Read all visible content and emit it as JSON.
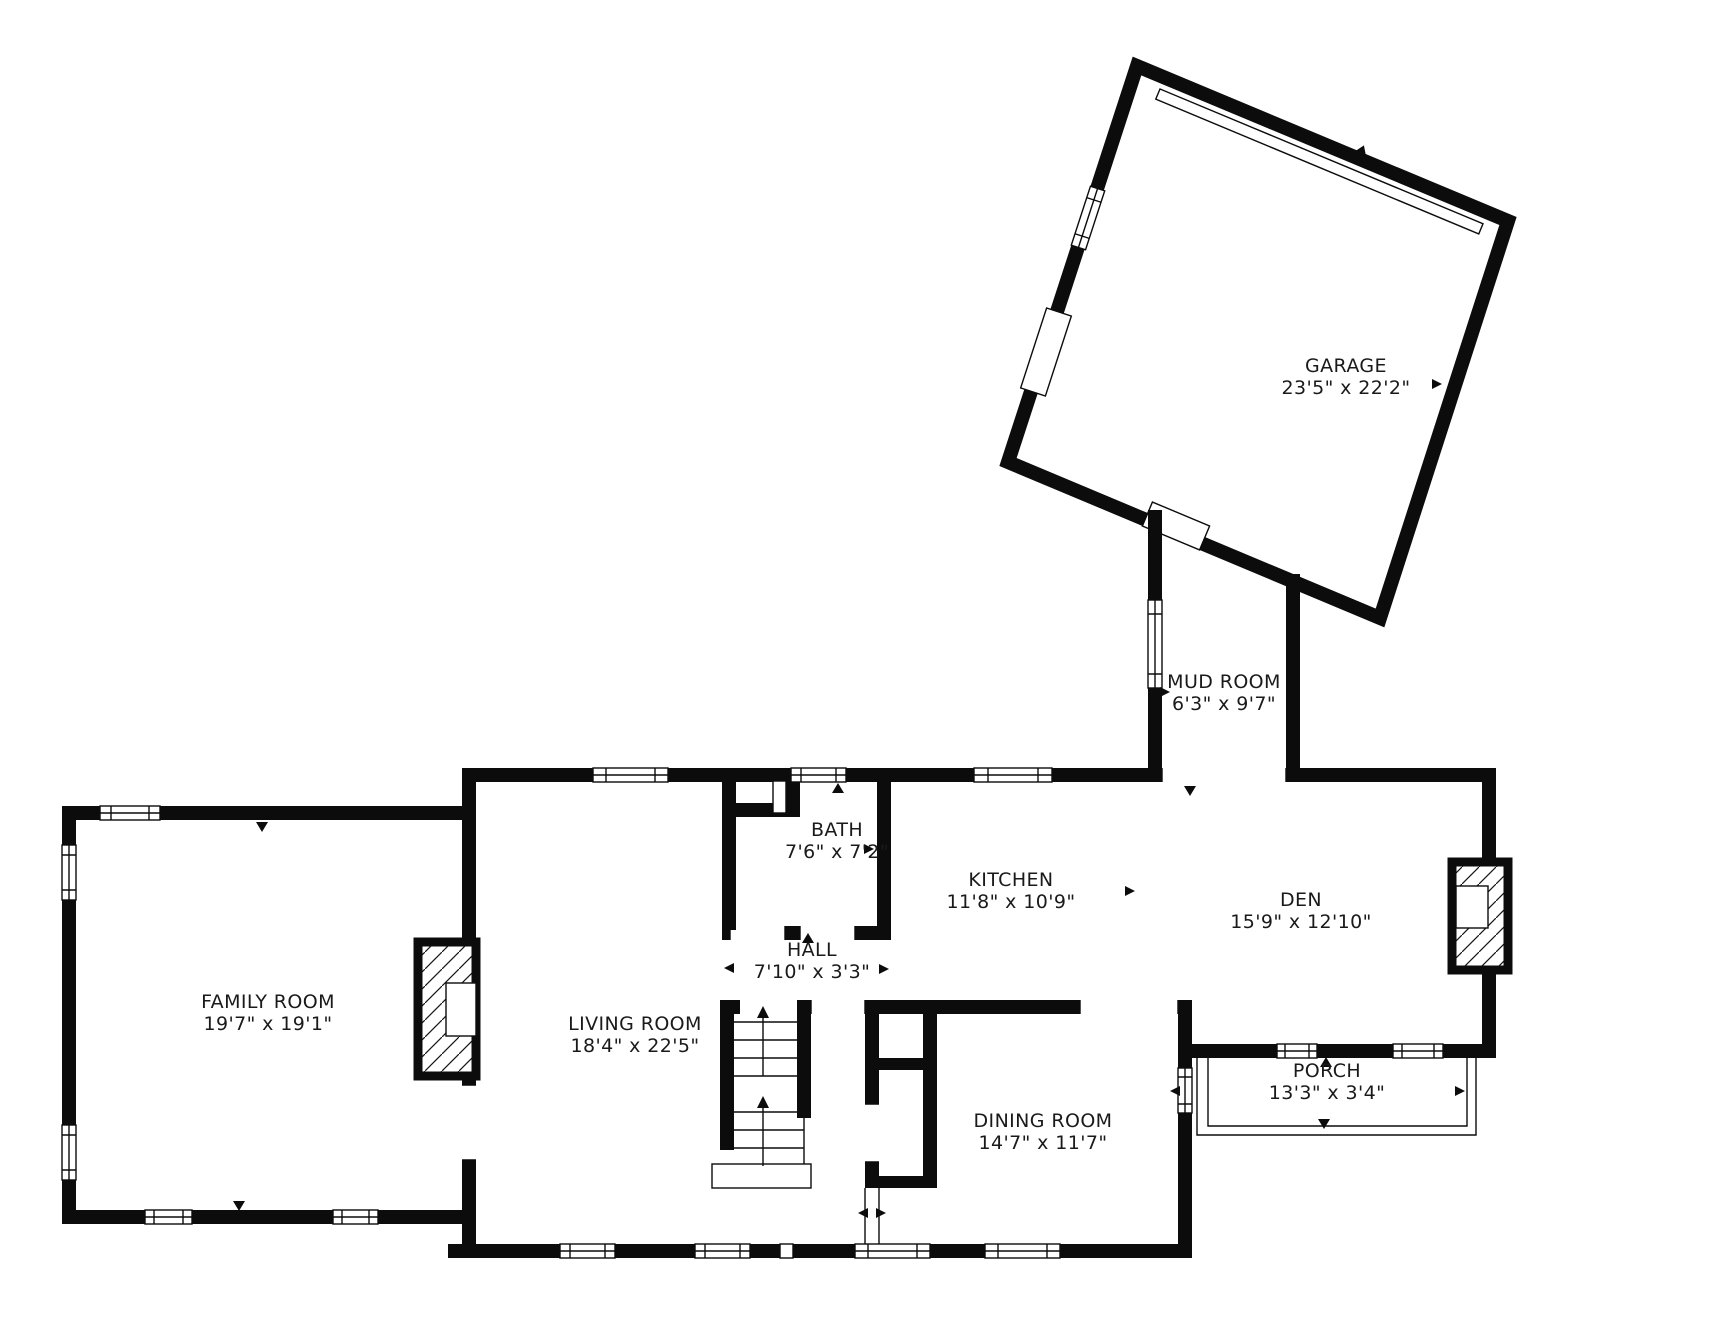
{
  "floorplan": {
    "background_color": "#ffffff",
    "wall_color": "#0c0c0c",
    "text_color": "#1a1a1a",
    "rooms": [
      {
        "id": "garage",
        "name": "GARAGE",
        "dims": "23'5\" x 22'2\"",
        "label_x": 1346,
        "label_y": 372
      },
      {
        "id": "mud-room",
        "name": "MUD ROOM",
        "dims": "6'3\" x 9'7\"",
        "label_x": 1224,
        "label_y": 688
      },
      {
        "id": "bath",
        "name": "BATH",
        "dims": "7'6\" x 7'2\"",
        "label_x": 837,
        "label_y": 836
      },
      {
        "id": "kitchen",
        "name": "KITCHEN",
        "dims": "11'8\" x 10'9\"",
        "label_x": 1011,
        "label_y": 886
      },
      {
        "id": "den",
        "name": "DEN",
        "dims": "15'9\" x 12'10\"",
        "label_x": 1301,
        "label_y": 906
      },
      {
        "id": "hall",
        "name": "HALL",
        "dims": "7'10\" x 3'3\"",
        "label_x": 812,
        "label_y": 956
      },
      {
        "id": "family-room",
        "name": "FAMILY ROOM",
        "dims": "19'7\" x 19'1\"",
        "label_x": 268,
        "label_y": 1008
      },
      {
        "id": "living-room",
        "name": "LIVING ROOM",
        "dims": "18'4\" x 22'5\"",
        "label_x": 635,
        "label_y": 1030
      },
      {
        "id": "dining-room",
        "name": "DINING ROOM",
        "dims": "14'7\" x 11'7\"",
        "label_x": 1043,
        "label_y": 1127
      },
      {
        "id": "porch",
        "name": "PORCH",
        "dims": "13'3\" x 3'4\"",
        "label_x": 1327,
        "label_y": 1077
      }
    ]
  }
}
